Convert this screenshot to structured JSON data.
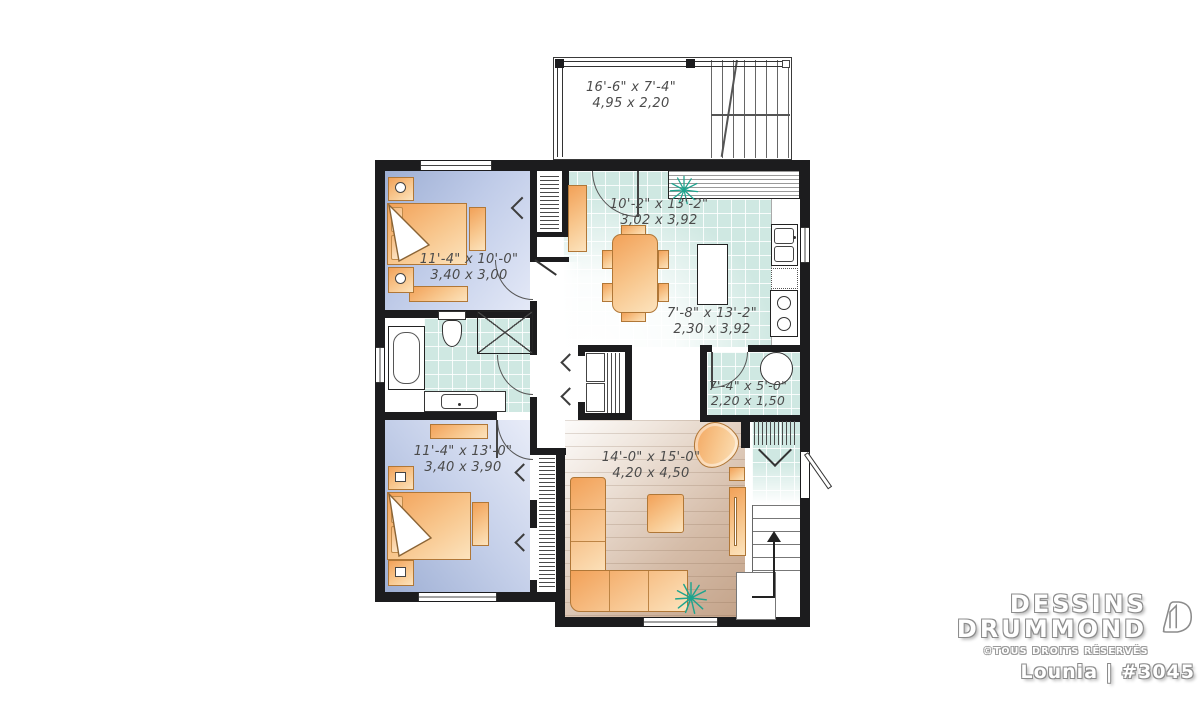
{
  "brand": {
    "line1": "DESSINS",
    "line2": "DRUMMOND",
    "copyright": "©TOUS DROITS RÉSERVÉS",
    "plan_name": "Lounia | #3045"
  },
  "rooms": {
    "deck": {
      "imperial": "16'-6\" x 7'-4\"",
      "metric": "4,95 x 2,20"
    },
    "bedroom1": {
      "imperial": "11'-4\" x 10'-0\"",
      "metric": "3,40 x 3,00"
    },
    "dining": {
      "imperial": "10'-2\" x 13'-2\"",
      "metric": "3,02 x 3,92"
    },
    "kitchen": {
      "imperial": "7'-8\" x 13'-2\"",
      "metric": "2,30 x 3,92"
    },
    "laundry": {
      "imperial": "7'-4\" x 5'-0\"",
      "metric": "2,20 x 1,50"
    },
    "bedroom2": {
      "imperial": "11'-4\" x 13'-0\"",
      "metric": "3,40 x 3,90"
    },
    "living": {
      "imperial": "14'-0\" x 15'-0\"",
      "metric": "4,20 x 4,50"
    }
  },
  "colors": {
    "wall": "#1c1c1e",
    "tile_floor": "#cfe8e2",
    "bedroom_floor": "#b9c6e4",
    "wood_floor": "#d3bba7",
    "furniture": "#f4ab62",
    "plant": "#1ea48e"
  }
}
